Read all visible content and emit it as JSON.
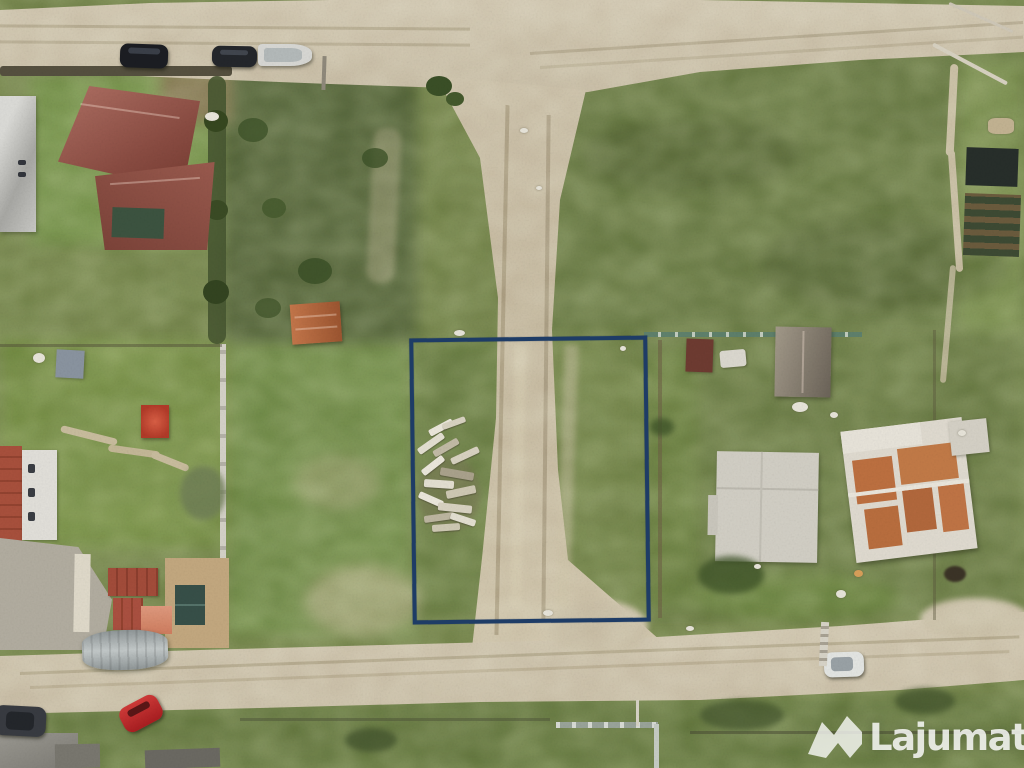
{
  "image": {
    "kind": "aerial-drone-photo",
    "subject": "vacant land plot for sale outlined in navy blue among suburban lots, dirt roads, houses and a construction site"
  },
  "watermark": {
    "brand": "Lajumate",
    "suffix": ".ro",
    "logo": "lajumate-logo",
    "color": "rgba(255,255,255,0.82)"
  },
  "plot_outline": {
    "color": "#1e3c66",
    "stroke_px": 4
  },
  "palette": {
    "grass_base": "#76874b",
    "grass_dark": "#55663a",
    "grass_bright": "#7fa04a",
    "road_dirt": "#c9bda6",
    "roof_red": "#8e5147",
    "roof_orange_shed": "#b06a42",
    "gazebo_red": "#c14b38",
    "construction_floor": "#bd7040",
    "foundation_slab": "#d2cfc5",
    "car_red": "#c1272d",
    "car_dark": "#1b1d22",
    "car_white": "#e4e6e3"
  }
}
